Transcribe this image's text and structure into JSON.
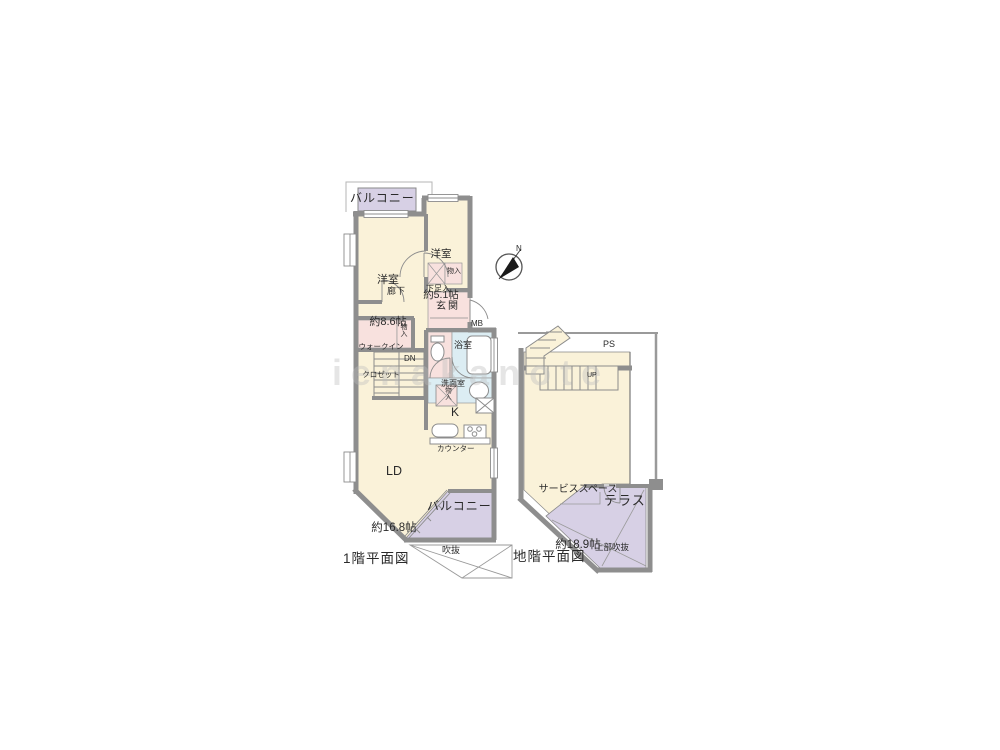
{
  "floor1": {
    "caption": "1階平面図",
    "balcony_top": "バルコニー",
    "balcony_bottom": "バルコニー",
    "bedroom1_name": "洋室",
    "bedroom1_size": "約8.6帖",
    "bedroom2_name": "洋室",
    "bedroom2_size": "約5.1帖",
    "corridor": "廊下",
    "entrance": "玄関",
    "shoe_storage": "下足入",
    "hall_storage": "物入",
    "wic_line1": "ウォークイン",
    "wic_line2": "クロゼット",
    "wic_storage": "物入",
    "stairs_down": "DN",
    "meter_box": "MB",
    "bathroom": "浴室",
    "washroom": "洗面室",
    "wash_storage": "物入",
    "kitchen": "K",
    "counter": "カウンター",
    "living_name": "LD",
    "living_size": "約16.8帖",
    "void": "吹抜"
  },
  "basement": {
    "caption": "地階平面図",
    "pipe_space": "PS",
    "stairs_up": "UP",
    "service_name": "サービススペース",
    "service_size": "約18.9帖",
    "terrace": "テラス",
    "upper_void": "上部吹抜"
  },
  "compass": {
    "north": "N"
  },
  "watermark": "ienakanote",
  "colors": {
    "floor": "#faf2d9",
    "balcony_terrace": "#d7d0e5",
    "entrance_closet": "#f8e1de",
    "bath_wash": "#dcedf3",
    "wall": "#8e8e8e"
  }
}
